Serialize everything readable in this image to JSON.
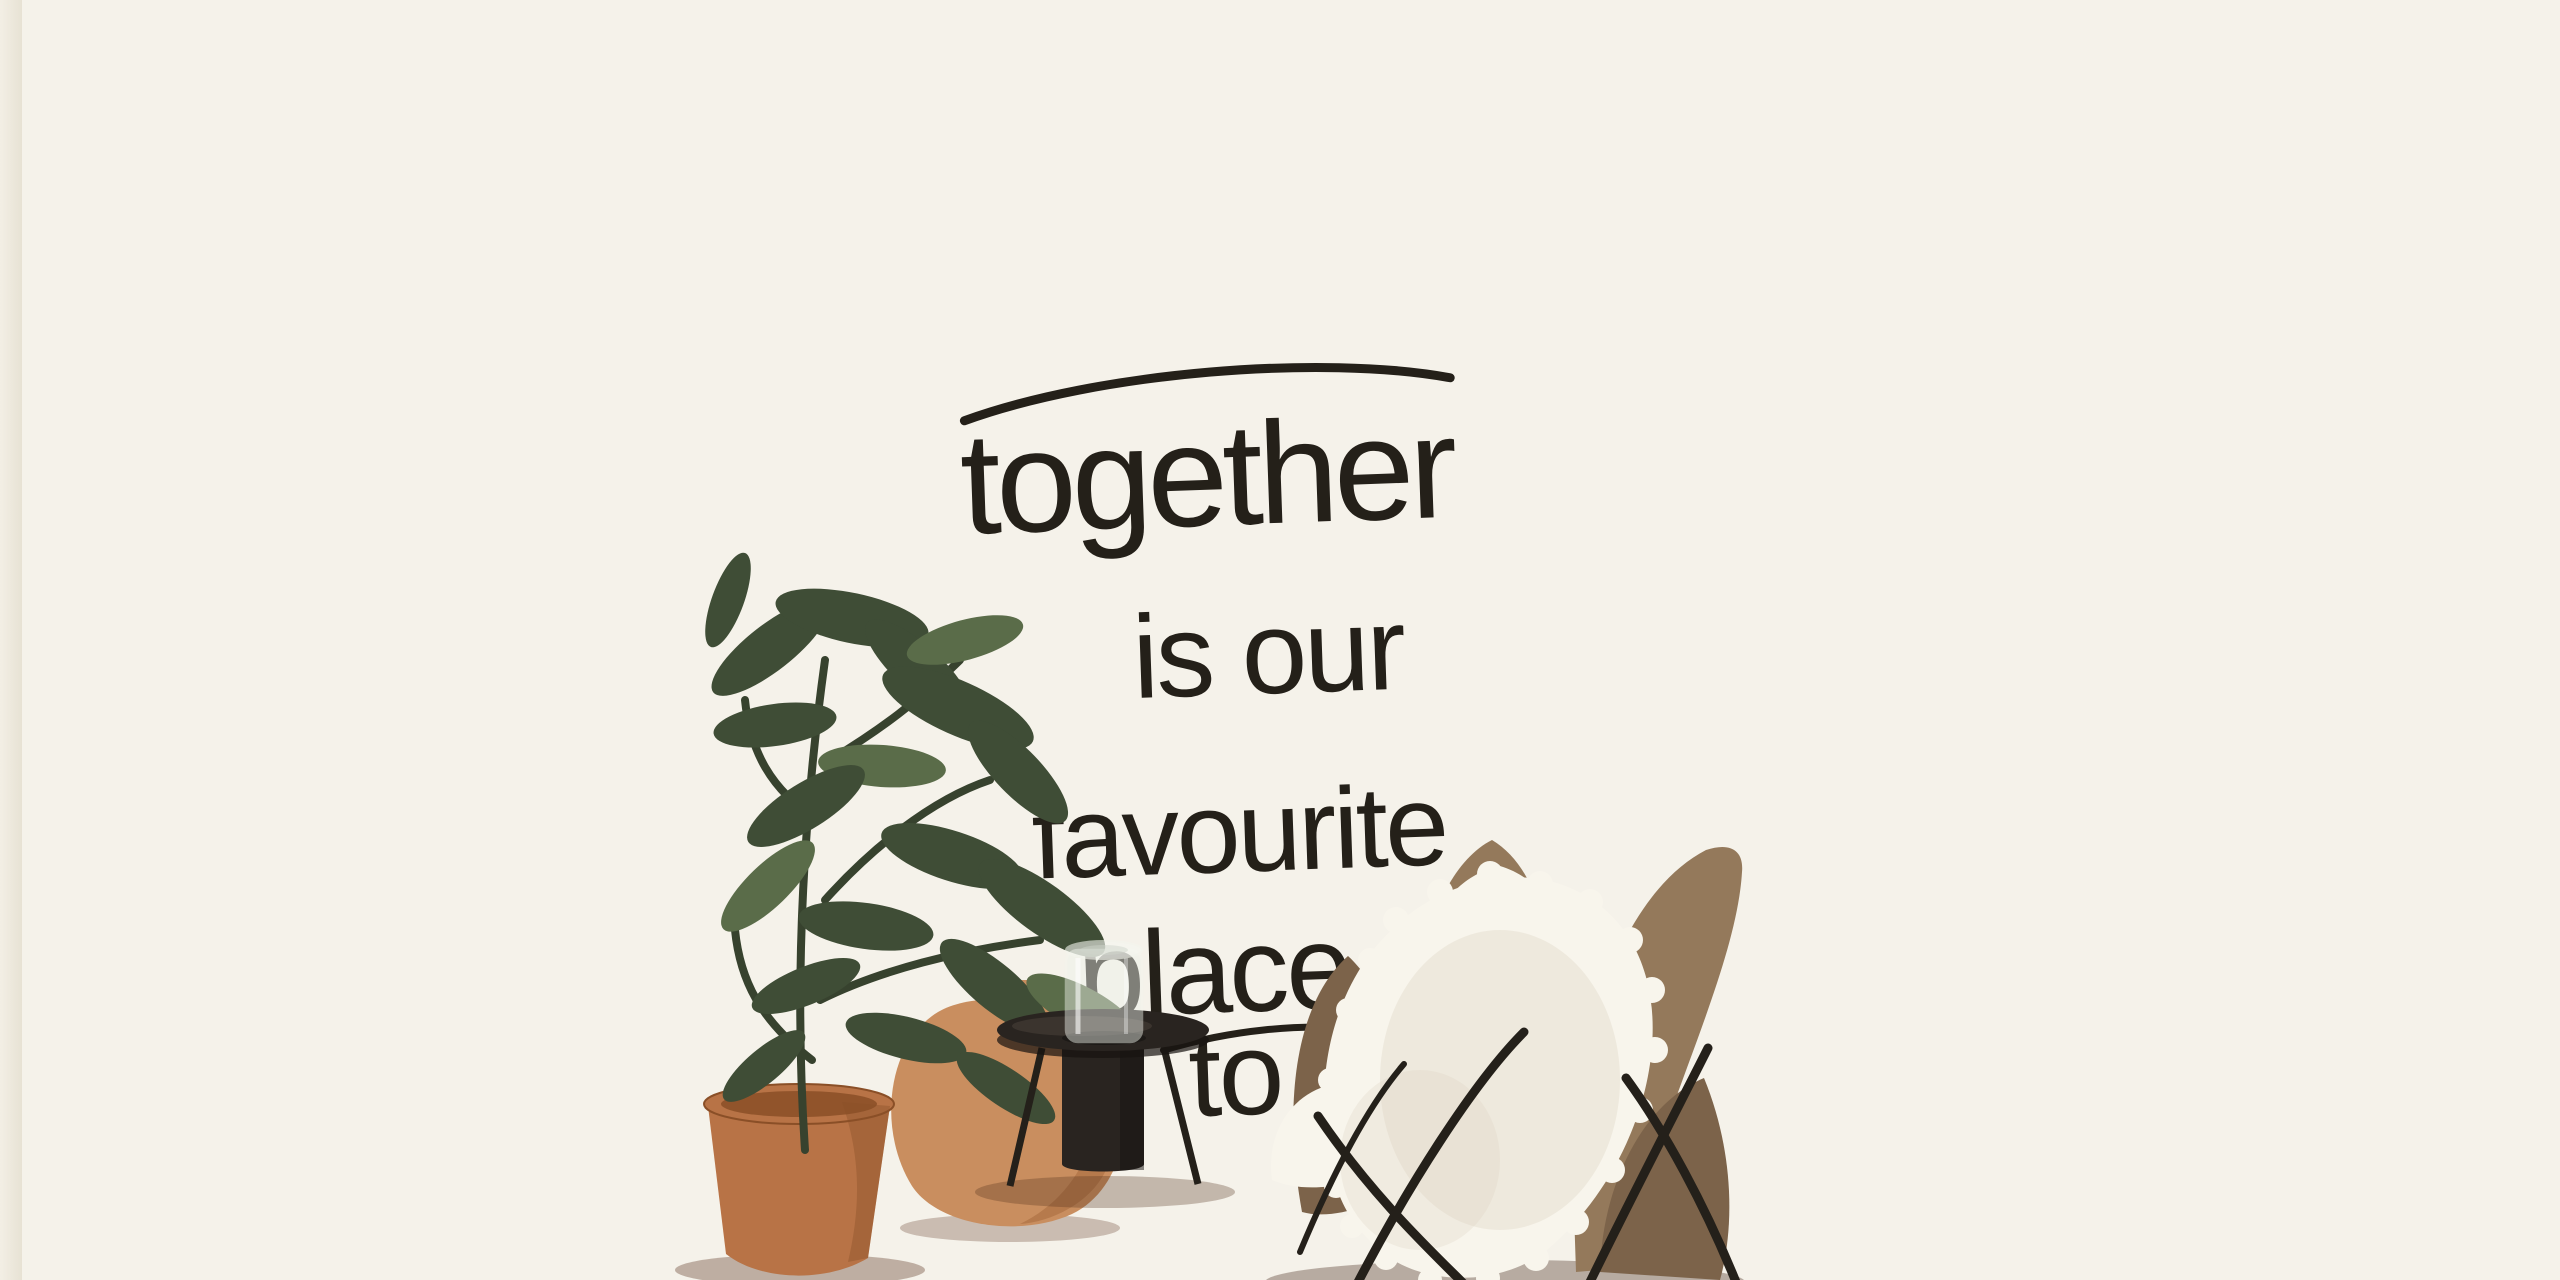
{
  "scene": {
    "description": "Bright hallway interior: wooden beam ceiling, script quote wall mural, potted plant, black side table with glass vase, butterfly chair with sheepskin, terracotta tiled stairs and white brick wall",
    "quote": {
      "lines": [
        "together",
        "is our",
        "favourite",
        "place",
        "to be"
      ],
      "full_text": "together is our favourite place to be"
    },
    "palette": {
      "left_strip": "#f3efe5",
      "left_wall": "#a3967f",
      "window_frame": "#eee9db",
      "window_glow": "#fdfcf4",
      "window_mullion": "#9a8d77",
      "ceiling_panel": "#a27948",
      "beam_light": "#d9bb8b",
      "beam_edge": "#b6935f",
      "plank": "#e8d8b5",
      "main_wall": "#f5f2ea",
      "main_wall_shade": "#e4ddcb",
      "quote_ink": "#242019",
      "brick_light": "#dcd6c7",
      "brick_dark": "#c9c1ae",
      "arch_cream": "#f4f0e6",
      "arch_shade": "#e9e3d3",
      "khaki_light": "#b1a078",
      "khaki_dark": "#8b7a58",
      "stringer_white": "#f1ece0",
      "step_face": "#a4613f",
      "step_tread": "#c08157",
      "step_grout": "#eddabf",
      "floor_light": "#e3c9b4",
      "floor_mid": "#cfa88b",
      "floor_dark": "#a5734f",
      "floor_grout": "#f8f0e4",
      "right_col_light": "#95846c",
      "right_col_dark": "#7a6951",
      "right_brick": "#ebe8e0",
      "right_brick_line": "#d6d2c6",
      "right_brick_edge": "#f7f4ec",
      "pot_light": "#b87346",
      "pot_dark": "#8a4f27",
      "urn_light": "#c98e5f",
      "urn_dark": "#a56a3c",
      "leaf_dark": "#3f4d36",
      "leaf_light": "#5a6c49",
      "stem": "#37422e",
      "table_black": "#292420",
      "table_sheen": "#4a423a",
      "vase_stroke": "#f4f6ee",
      "chair_leather": "#94795b",
      "chair_leather_dark": "#7c634a",
      "fur": "#f8f5ec",
      "fur_shadow": "#ddd5c2",
      "leg_black": "#24201a"
    }
  }
}
